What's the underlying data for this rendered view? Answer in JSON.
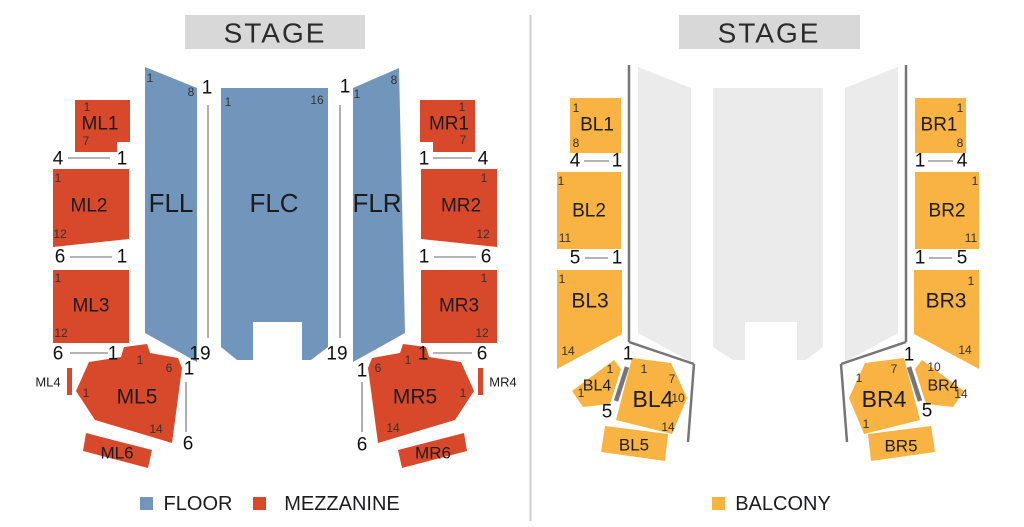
{
  "colors": {
    "floor": "#7295bb",
    "mezzanine": "#d7492a",
    "balcony": "#f8b342",
    "floor_muted": "#ebebeb",
    "stage_bar": "#d8d8d8",
    "rail": "#767676",
    "indicator_line": "#9b9b9b",
    "divider": "#cfcfcf",
    "label_text": "#1c1c1e",
    "small_number_text": "#333333",
    "big_number_text": "#111111",
    "stage_text": "#2b2b2b"
  },
  "left": {
    "stage_label": "STAGE",
    "legend": [
      {
        "label": "FLOOR",
        "color": "#7295bb"
      },
      {
        "label": "MEZZANINE",
        "color": "#d7492a"
      }
    ],
    "sections": {
      "FLL": "FLL",
      "FLC": "FLC",
      "FLR": "FLR",
      "ML1": "ML1",
      "ML2": "ML2",
      "ML3": "ML3",
      "ML4": "ML4",
      "ML5": "ML5",
      "ML6": "ML6",
      "MR1": "MR1",
      "MR2": "MR2",
      "MR3": "MR3",
      "MR4": "MR4",
      "MR5": "MR5",
      "MR6": "MR6"
    },
    "small_numbers": [
      "1",
      "8",
      "1",
      "16",
      "1",
      "8",
      "1",
      "7",
      "1",
      "12",
      "1",
      "12",
      "1",
      "6",
      "1",
      "14",
      "1",
      "7",
      "1",
      "12",
      "1",
      "12",
      "6",
      "1",
      "1",
      "14"
    ],
    "big_numbers": [
      "1",
      "1",
      "19",
      "19",
      "4",
      "1",
      "6",
      "1",
      "6",
      "1",
      "1",
      "6",
      "1",
      "4",
      "1",
      "6",
      "1",
      "6",
      "1",
      "6"
    ]
  },
  "right": {
    "stage_label": "STAGE",
    "legend": [
      {
        "label": "BALCONY",
        "color": "#f8b342"
      }
    ],
    "sections": {
      "BL1": "BL1",
      "BL2": "BL2",
      "BL3": "BL3",
      "BL4_SMALL": "BL4",
      "BL4_BIG": "BL4",
      "BL5": "BL5",
      "BR1": "BR1",
      "BR2": "BR2",
      "BR3": "BR3",
      "BR4_SMALL": "BR4",
      "BR4_BIG": "BR4",
      "BR5": "BR5"
    },
    "small_numbers": [
      "1",
      "8",
      "1",
      "11",
      "1",
      "14",
      "1",
      "1",
      "1",
      "7",
      "10",
      "14",
      "1",
      "8",
      "1",
      "11",
      "1",
      "14",
      "7",
      "1",
      "1",
      "10",
      "14"
    ],
    "big_numbers": [
      "4",
      "1",
      "5",
      "1",
      "1",
      "5",
      "1",
      "4",
      "1",
      "5",
      "1",
      "5"
    ]
  }
}
